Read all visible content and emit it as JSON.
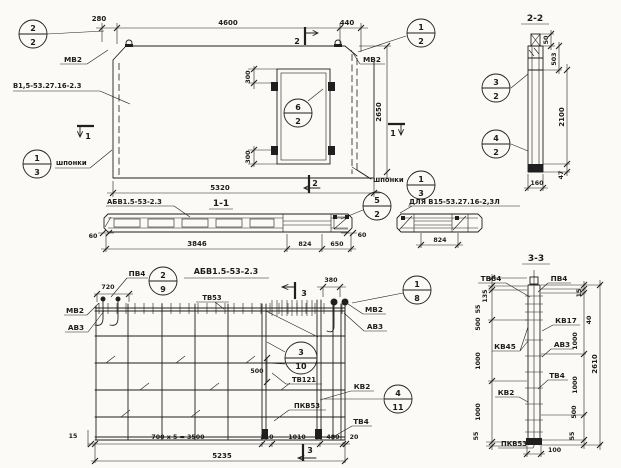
{
  "colors": {
    "paper": "#fbfaf6",
    "ink": "#1f1f1f"
  },
  "panel": {
    "mark_label": "В1,5-53.27.16-2.3",
    "mv2_left": "МВ2",
    "mv2_right": "МВ2",
    "shponki_left": "шпонки",
    "shponki_right": "шпонки",
    "dims": {
      "w280": "280",
      "w4600": "4600",
      "w440": "440",
      "w5320": "5320",
      "h2650": "2650",
      "o300t": "300",
      "o300b": "300"
    },
    "sections": {
      "s1": "1",
      "s2": "2"
    },
    "callouts": {
      "c22": {
        "num": "2",
        "den": "2"
      },
      "c12": {
        "num": "1",
        "den": "2"
      },
      "c62": {
        "num": "6",
        "den": "2"
      },
      "c13l": {
        "num": "1",
        "den": "3"
      },
      "c13r": {
        "num": "1",
        "den": "3"
      }
    }
  },
  "section22": {
    "title": "2-2",
    "dims": {
      "d50": "50",
      "d503": "503",
      "d2100": "2100",
      "d47": "47",
      "d160": "160"
    },
    "callouts": {
      "c32": {
        "num": "3",
        "den": "2"
      },
      "c42": {
        "num": "4",
        "den": "2"
      }
    }
  },
  "section11": {
    "title": "1-1",
    "mark_label": "АБВ1.5-53-2.3",
    "dims": {
      "d60l": "60",
      "d3846": "3846",
      "d824": "824",
      "d650": "650",
      "d60r": "60"
    },
    "callouts": {
      "c52": {
        "num": "5",
        "den": "2"
      }
    }
  },
  "detail": {
    "label": "ДЛЯ В15-53.27.16-2,3Л",
    "dims": {
      "d824": "824"
    }
  },
  "cage": {
    "title": "АБВ1.5-53-2.3",
    "labels": {
      "pv4": "ПВ4",
      "tv53": "ТВ53",
      "mv2l": "МВ2",
      "av3l": "АВ3",
      "mv2r": "МВ2",
      "av3r": "АВ3",
      "tv121": "ТВ121",
      "kv2": "КВ2",
      "pkv53": "ПКВ53",
      "tv4": "ТВ4"
    },
    "dims": {
      "d720": "720",
      "d380": "380",
      "d500": "500",
      "d15": "15",
      "d700x5": "700 x 5 = 3500",
      "d210": "210",
      "d1010": "1010",
      "d480": "480",
      "d20": "20",
      "d5235": "5235"
    },
    "sections": {
      "s3": "3"
    },
    "callouts": {
      "c29": {
        "num": "2",
        "den": "9"
      },
      "c18": {
        "num": "1",
        "den": "8"
      },
      "c310": {
        "num": "3",
        "den": "10"
      },
      "c411": {
        "num": "4",
        "den": "11"
      }
    }
  },
  "section33": {
    "title": "3-3",
    "labels": {
      "tv84": "ТВ84",
      "pv4": "ПВ4",
      "kv17": "КВ17",
      "av3": "АВ3",
      "kv45": "КВ45",
      "tv4": "ТВ4",
      "kv2": "КВ2",
      "pkv53": "ПКВ53"
    },
    "dims_left": [
      "135",
      "55",
      "500",
      "1000",
      "1000",
      "55"
    ],
    "dims_right": [
      "15",
      "40",
      "1000",
      "1000",
      "500",
      "55"
    ],
    "dims": {
      "total": "2610",
      "d100": "100"
    }
  }
}
